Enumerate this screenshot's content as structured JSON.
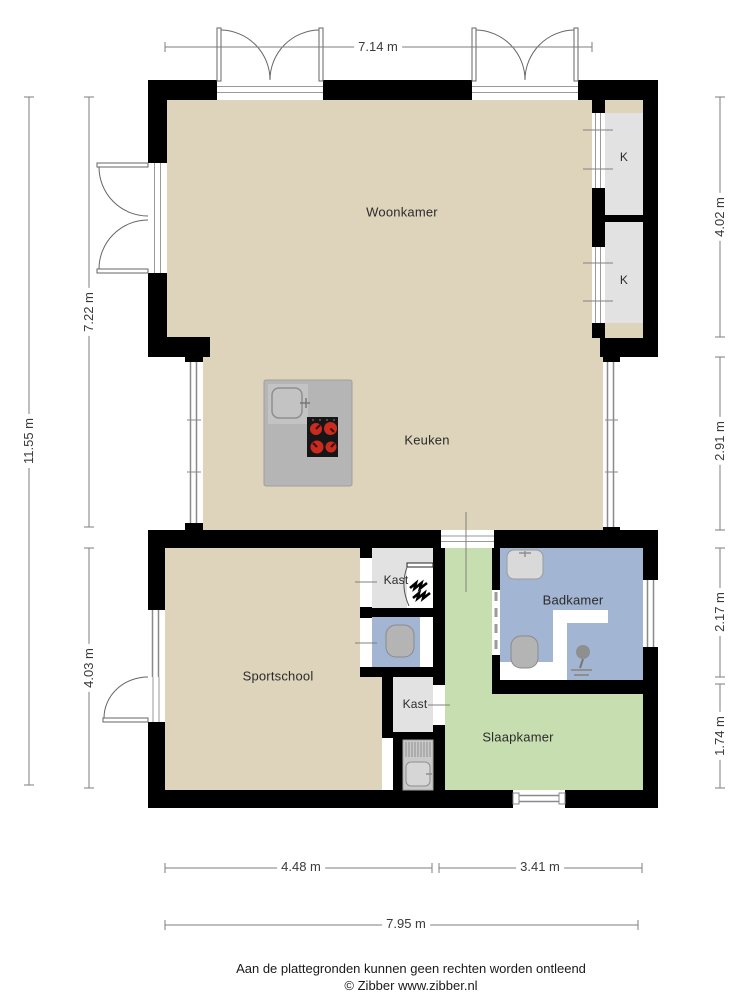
{
  "meta": {
    "footer_line1": "Aan de plattegronden kunnen geen rechten worden ontleend",
    "footer_line2": "© Zibber www.zibber.nl"
  },
  "rooms": {
    "woonkamer": {
      "label": "Woonkamer"
    },
    "keuken": {
      "label": "Keuken"
    },
    "sportschool": {
      "label": "Sportschool"
    },
    "slaapkamer": {
      "label": "Slaapkamer"
    },
    "badkamer": {
      "label": "Badkamer"
    },
    "kast_boven": {
      "label": "Kast"
    },
    "kast_onder": {
      "label": "Kast"
    },
    "closet_k1": {
      "label": "K"
    },
    "closet_k2": {
      "label": "K"
    }
  },
  "dimensions": {
    "top_width": "7.14 m",
    "left_total": "11.55 m",
    "left_upper": "7.22 m",
    "left_lower": "4.03 m",
    "right_upper": "4.02 m",
    "right_middle": "2.91 m",
    "right_lower_upper": "2.17 m",
    "right_lower_bottom": "1.74 m",
    "bottom_left": "4.48 m",
    "bottom_right": "3.41 m",
    "bottom_total": "7.95 m"
  },
  "colors": {
    "floor": "#DDD4BB",
    "bedroom": "#C7DEB1",
    "bathroom": "#A2B5D2",
    "closet": "#E2E2E2",
    "island": "#B5B5B5",
    "wall": "#000000",
    "burner": "#CB2A1E"
  }
}
